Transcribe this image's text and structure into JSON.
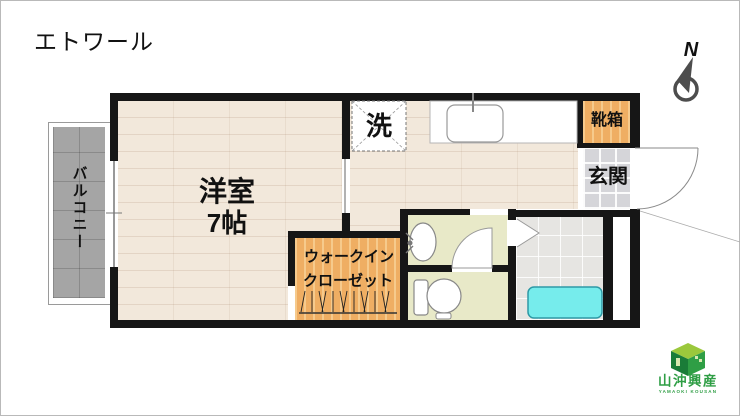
{
  "title": "エトワール",
  "compass": {
    "label": "N"
  },
  "rooms": {
    "living": {
      "name": "洋室",
      "size": "7帖"
    },
    "balcony": {
      "name": "バルコニー"
    },
    "washer": {
      "name": "洗"
    },
    "shoebox": {
      "name": "靴箱"
    },
    "entrance": {
      "name": "玄関"
    },
    "closet": {
      "line1": "ウォークイン",
      "line2": "クローゼット"
    }
  },
  "logo": {
    "company": "山沖興産",
    "romaji": "YAMAOKI KOUSAN"
  },
  "colors": {
    "wall": "#161616",
    "ink": "#111111",
    "wood": "#f2e8db",
    "orange": "#efae63",
    "tile": "#d5d5d9",
    "bath": "#e6e5e2",
    "green": "#e8e9c8",
    "tub": "#76ecec",
    "tub_edge": "#2e9aa6",
    "balcony": "#a5a5a5",
    "logo_green": "#2f9e45",
    "logo_dark": "#1a7c38",
    "logo_light": "#9bc83c"
  }
}
